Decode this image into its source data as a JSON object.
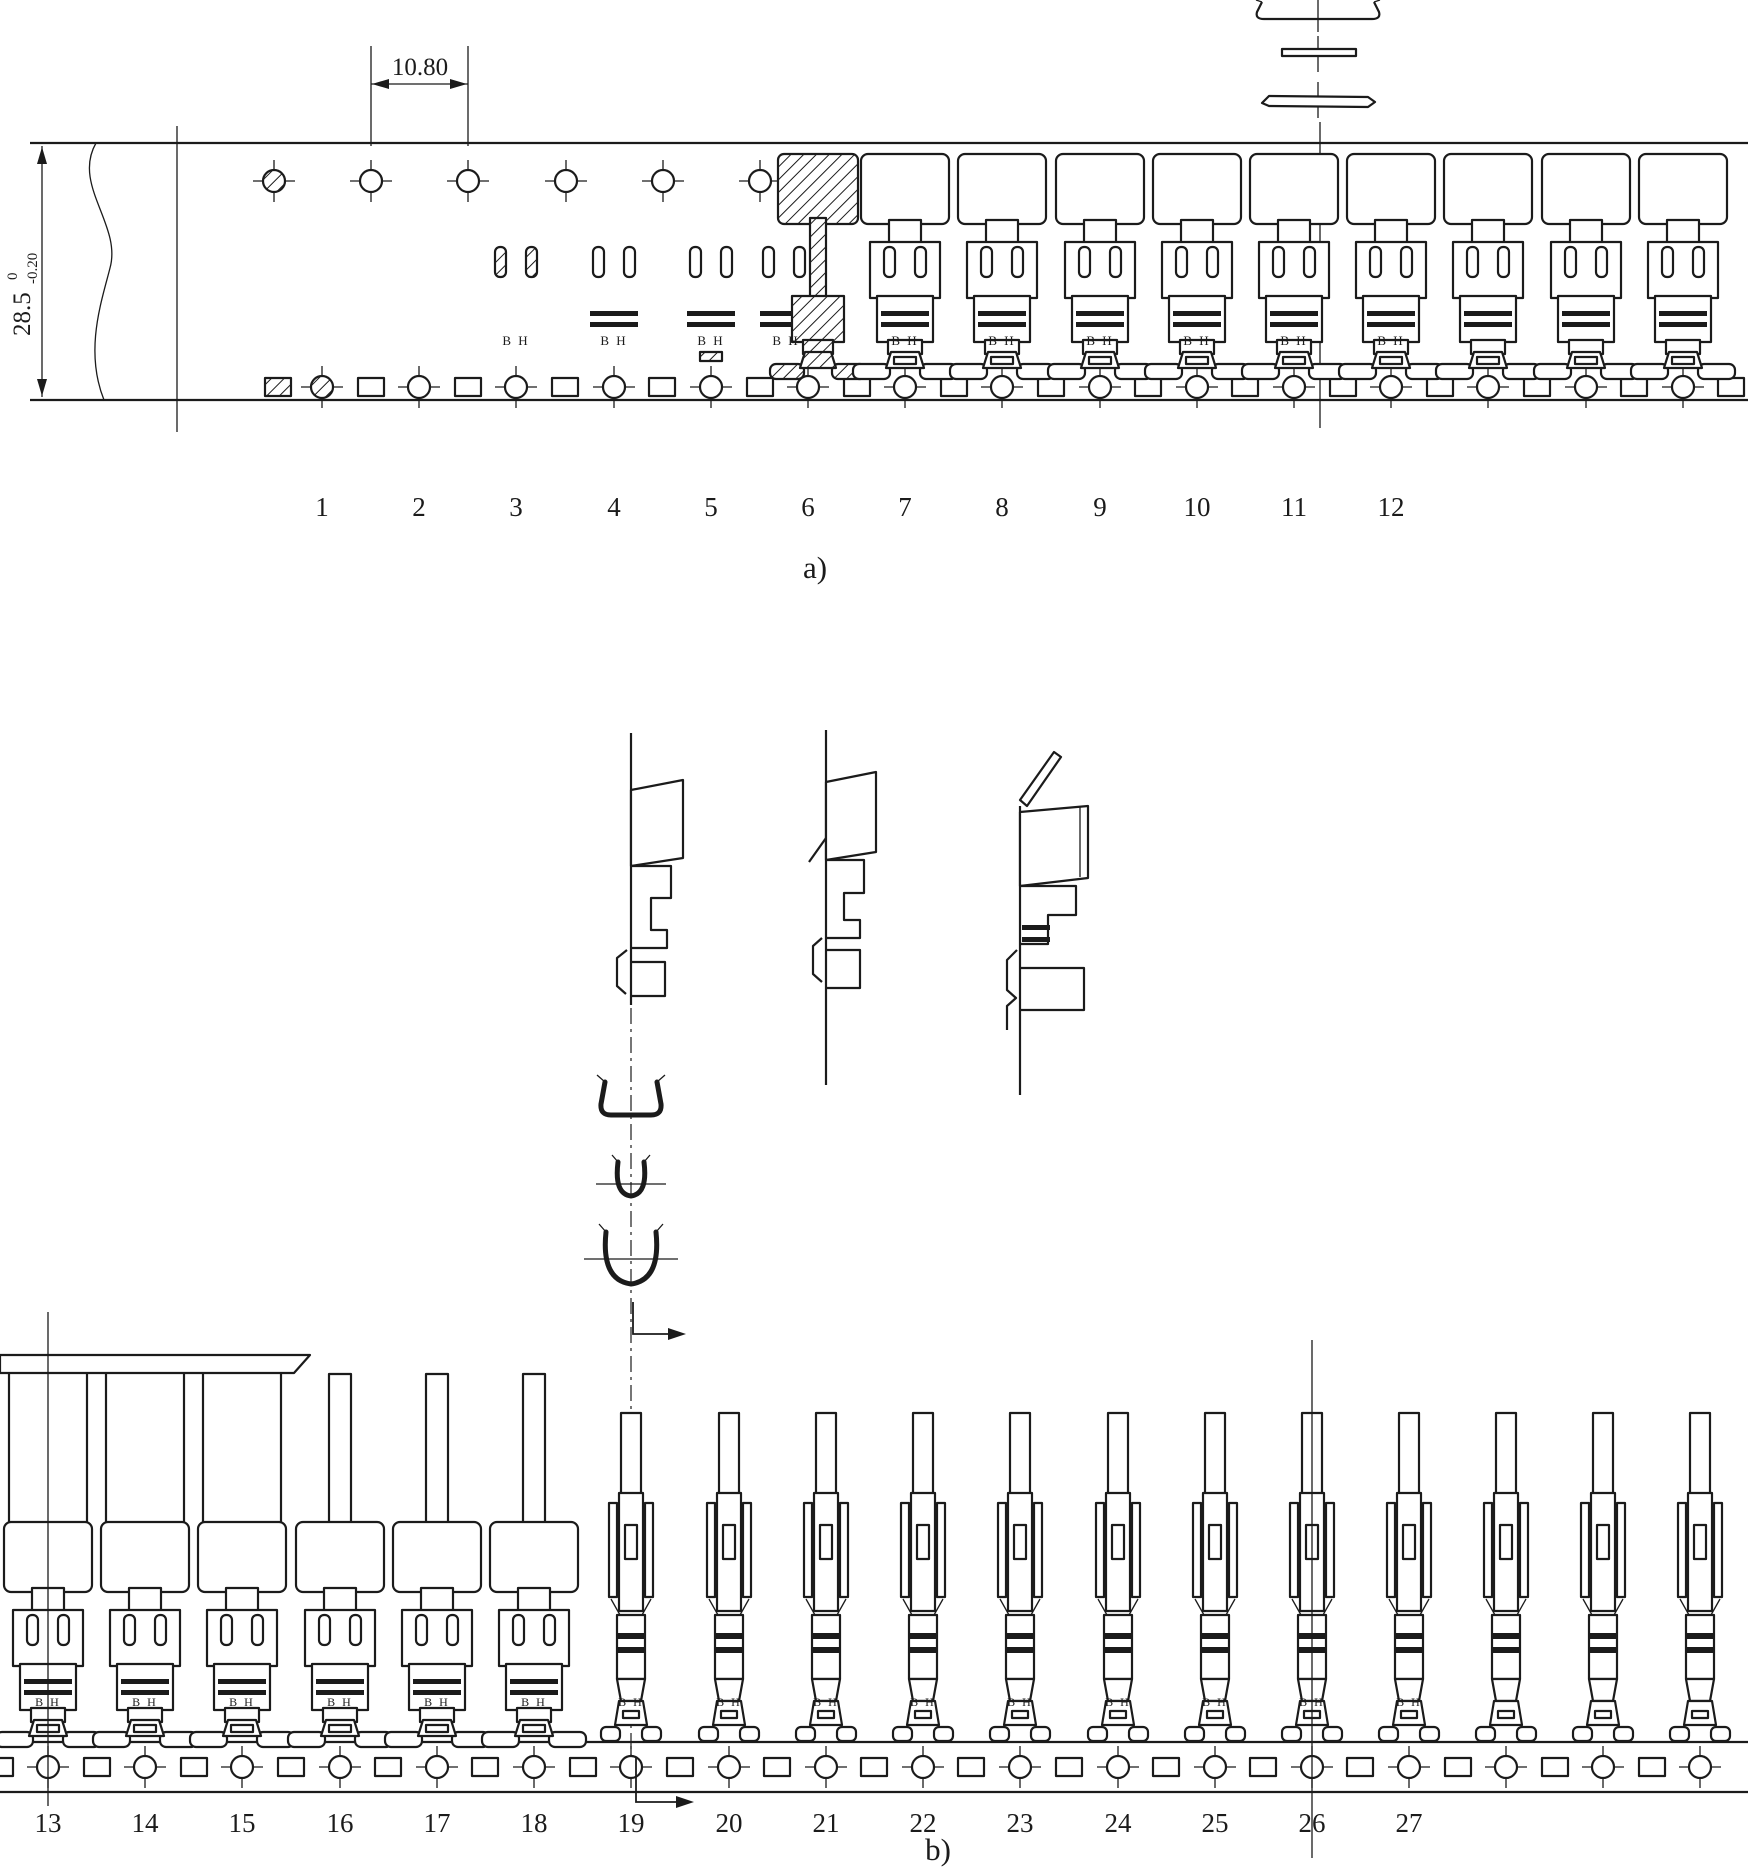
{
  "figure": {
    "background": "#ffffff",
    "line_color": "#1b1b1b",
    "labels": {
      "part_a": "a)",
      "part_b": "b)",
      "mark": "B H"
    },
    "dimensions": {
      "pitch": "10.80",
      "width_base": "28.5",
      "width_tol_sup": "0",
      "width_tol_sub": "-0.20"
    },
    "stations_a": [
      "1",
      "2",
      "3",
      "4",
      "5",
      "6",
      "7",
      "8",
      "9",
      "10",
      "11",
      "12"
    ],
    "stations_b": [
      "13",
      "14",
      "15",
      "16",
      "17",
      "18",
      "19",
      "20",
      "21",
      "22",
      "23",
      "24",
      "25",
      "26",
      "27"
    ]
  }
}
